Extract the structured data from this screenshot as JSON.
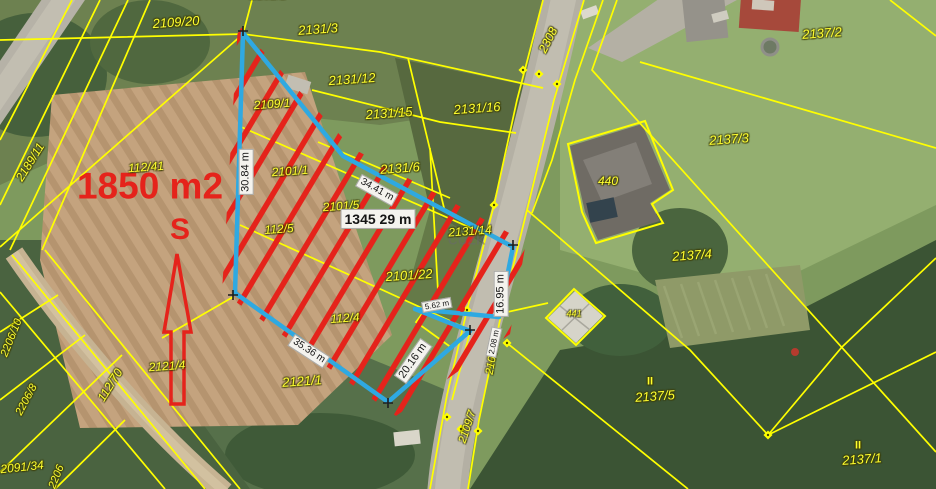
{
  "map": {
    "colors": {
      "highlight_outline": "#2fa9e1",
      "hatch_and_annotations": "#e5231b",
      "parcel_lines": "#ffff00",
      "measure_box_bg": "#f4f3ee"
    },
    "area_label": {
      "text": "1850 m2"
    },
    "north_label": {
      "text": "S"
    },
    "watermark": {
      "text": "ČÚZK"
    },
    "parcel_labels": [
      {
        "t": "2109/20",
        "x": 176,
        "y": 22,
        "r": -4,
        "s": 13
      },
      {
        "t": "2131/1",
        "x": 268,
        "y": -5,
        "r": 0,
        "s": 12
      },
      {
        "t": "2131/3",
        "x": 318,
        "y": 29,
        "r": -4,
        "s": 13
      },
      {
        "t": "2131/12",
        "x": 352,
        "y": 79,
        "r": -4,
        "s": 13
      },
      {
        "t": "2131/15",
        "x": 389,
        "y": 113,
        "r": -4,
        "s": 13
      },
      {
        "t": "2131/16",
        "x": 477,
        "y": 108,
        "r": -4,
        "s": 13
      },
      {
        "t": "2137/2",
        "x": 822,
        "y": 33,
        "r": -4,
        "s": 13
      },
      {
        "t": "2137/3",
        "x": 729,
        "y": 139,
        "r": -4,
        "s": 13
      },
      {
        "t": "440",
        "x": 608,
        "y": 181,
        "r": 0,
        "s": 12
      },
      {
        "t": "2137/4",
        "x": 692,
        "y": 255,
        "r": -4,
        "s": 13
      },
      {
        "t": "441",
        "x": 574,
        "y": 314,
        "r": 0,
        "s": 9
      },
      {
        "t": "2308",
        "x": 548,
        "y": 40,
        "r": -63,
        "s": 12
      },
      {
        "t": "2109/1",
        "x": 272,
        "y": 104,
        "r": -4,
        "s": 12
      },
      {
        "t": "2131/6",
        "x": 400,
        "y": 168,
        "r": -4,
        "s": 13
      },
      {
        "t": "2101/1",
        "x": 290,
        "y": 171,
        "r": -4,
        "s": 12
      },
      {
        "t": "2101/5",
        "x": 341,
        "y": 206,
        "r": -4,
        "s": 12
      },
      {
        "t": "112/5",
        "x": 279,
        "y": 229,
        "r": -4,
        "s": 12
      },
      {
        "t": "2131/14",
        "x": 470,
        "y": 231,
        "r": -4,
        "s": 12
      },
      {
        "t": "2101/22",
        "x": 409,
        "y": 275,
        "r": -4,
        "s": 13
      },
      {
        "t": "112/4",
        "x": 345,
        "y": 318,
        "r": -4,
        "s": 12
      },
      {
        "t": "2121/1",
        "x": 302,
        "y": 381,
        "r": -4,
        "s": 13
      },
      {
        "t": "2121/4",
        "x": 167,
        "y": 366,
        "r": -4,
        "s": 12
      },
      {
        "t": "112/41",
        "x": 146,
        "y": 167,
        "r": -4,
        "s": 12
      },
      {
        "t": "2189/11",
        "x": 30,
        "y": 162,
        "r": -58,
        "s": 12
      },
      {
        "t": "112/70",
        "x": 110,
        "y": 385,
        "r": -58,
        "s": 12
      },
      {
        "t": "2206/10",
        "x": 12,
        "y": 338,
        "r": -68,
        "s": 11
      },
      {
        "t": "2206/8",
        "x": 27,
        "y": 400,
        "r": -62,
        "s": 11
      },
      {
        "t": "2091/34",
        "x": 22,
        "y": 467,
        "r": -6,
        "s": 12
      },
      {
        "t": "2206",
        "x": 57,
        "y": 477,
        "r": -68,
        "s": 11
      },
      {
        "t": "2109/7",
        "x": 468,
        "y": 427,
        "r": -72,
        "s": 11
      },
      {
        "t": "2109/1",
        "x": 493,
        "y": 358,
        "r": -80,
        "s": 11
      },
      {
        "t": "II",
        "x": 650,
        "y": 382,
        "r": 0,
        "s": 11,
        "b": 1
      },
      {
        "t": "2137/5",
        "x": 655,
        "y": 396,
        "r": -4,
        "s": 13
      },
      {
        "t": "II",
        "x": 858,
        "y": 446,
        "r": 0,
        "s": 11,
        "b": 1
      },
      {
        "t": "2137/1",
        "x": 862,
        "y": 459,
        "r": -4,
        "s": 13
      }
    ],
    "measurement_labels": [
      {
        "t": "30.84 m",
        "x": 246,
        "y": 172,
        "r": -90,
        "s": 11
      },
      {
        "t": "1345 29 m",
        "x": 378,
        "y": 219,
        "r": 0,
        "s": 14,
        "big": 1
      },
      {
        "t": "34.41 m",
        "x": 377,
        "y": 190,
        "r": 29,
        "s": 10
      },
      {
        "t": "16.95 m",
        "x": 501,
        "y": 294,
        "r": -90,
        "s": 11
      },
      {
        "t": "5.62 m",
        "x": 437,
        "y": 305,
        "r": -10,
        "s": 8
      },
      {
        "t": "2.08 m",
        "x": 494,
        "y": 342,
        "r": -78,
        "s": 8
      },
      {
        "t": "20.16 m",
        "x": 413,
        "y": 361,
        "r": -55,
        "s": 11
      },
      {
        "t": "35.36 m",
        "x": 309,
        "y": 351,
        "r": 33,
        "s": 10
      }
    ]
  }
}
